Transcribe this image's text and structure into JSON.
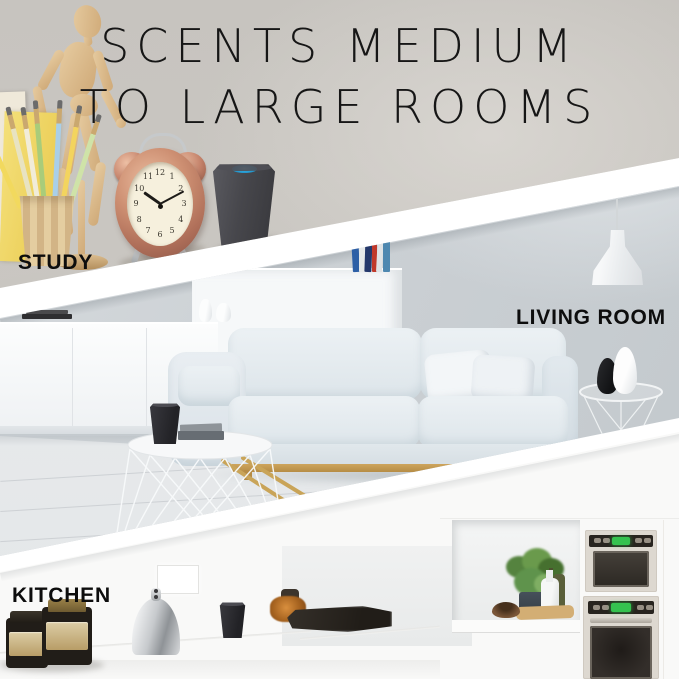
{
  "title": {
    "line1": "SCENTS MEDIUM",
    "line2": "TO LARGE ROOMS"
  },
  "sections": {
    "study": {
      "label": "STUDY"
    },
    "living_room": {
      "label": "LIVING ROOM"
    },
    "kitchen": {
      "label": "KITCHEN"
    }
  },
  "clock": {
    "numerals": [
      "12",
      "1",
      "2",
      "3",
      "4",
      "5",
      "6",
      "7",
      "8",
      "9",
      "10",
      "11"
    ],
    "hour_deg": 305,
    "minute_deg": 62
  },
  "colors": {
    "accent-blue": "#2ba3da",
    "copper": "#c98b6f",
    "green-display": "#35c24f",
    "wood": "#d9b98c",
    "title": "#161616",
    "label": "#0d0d0d"
  }
}
